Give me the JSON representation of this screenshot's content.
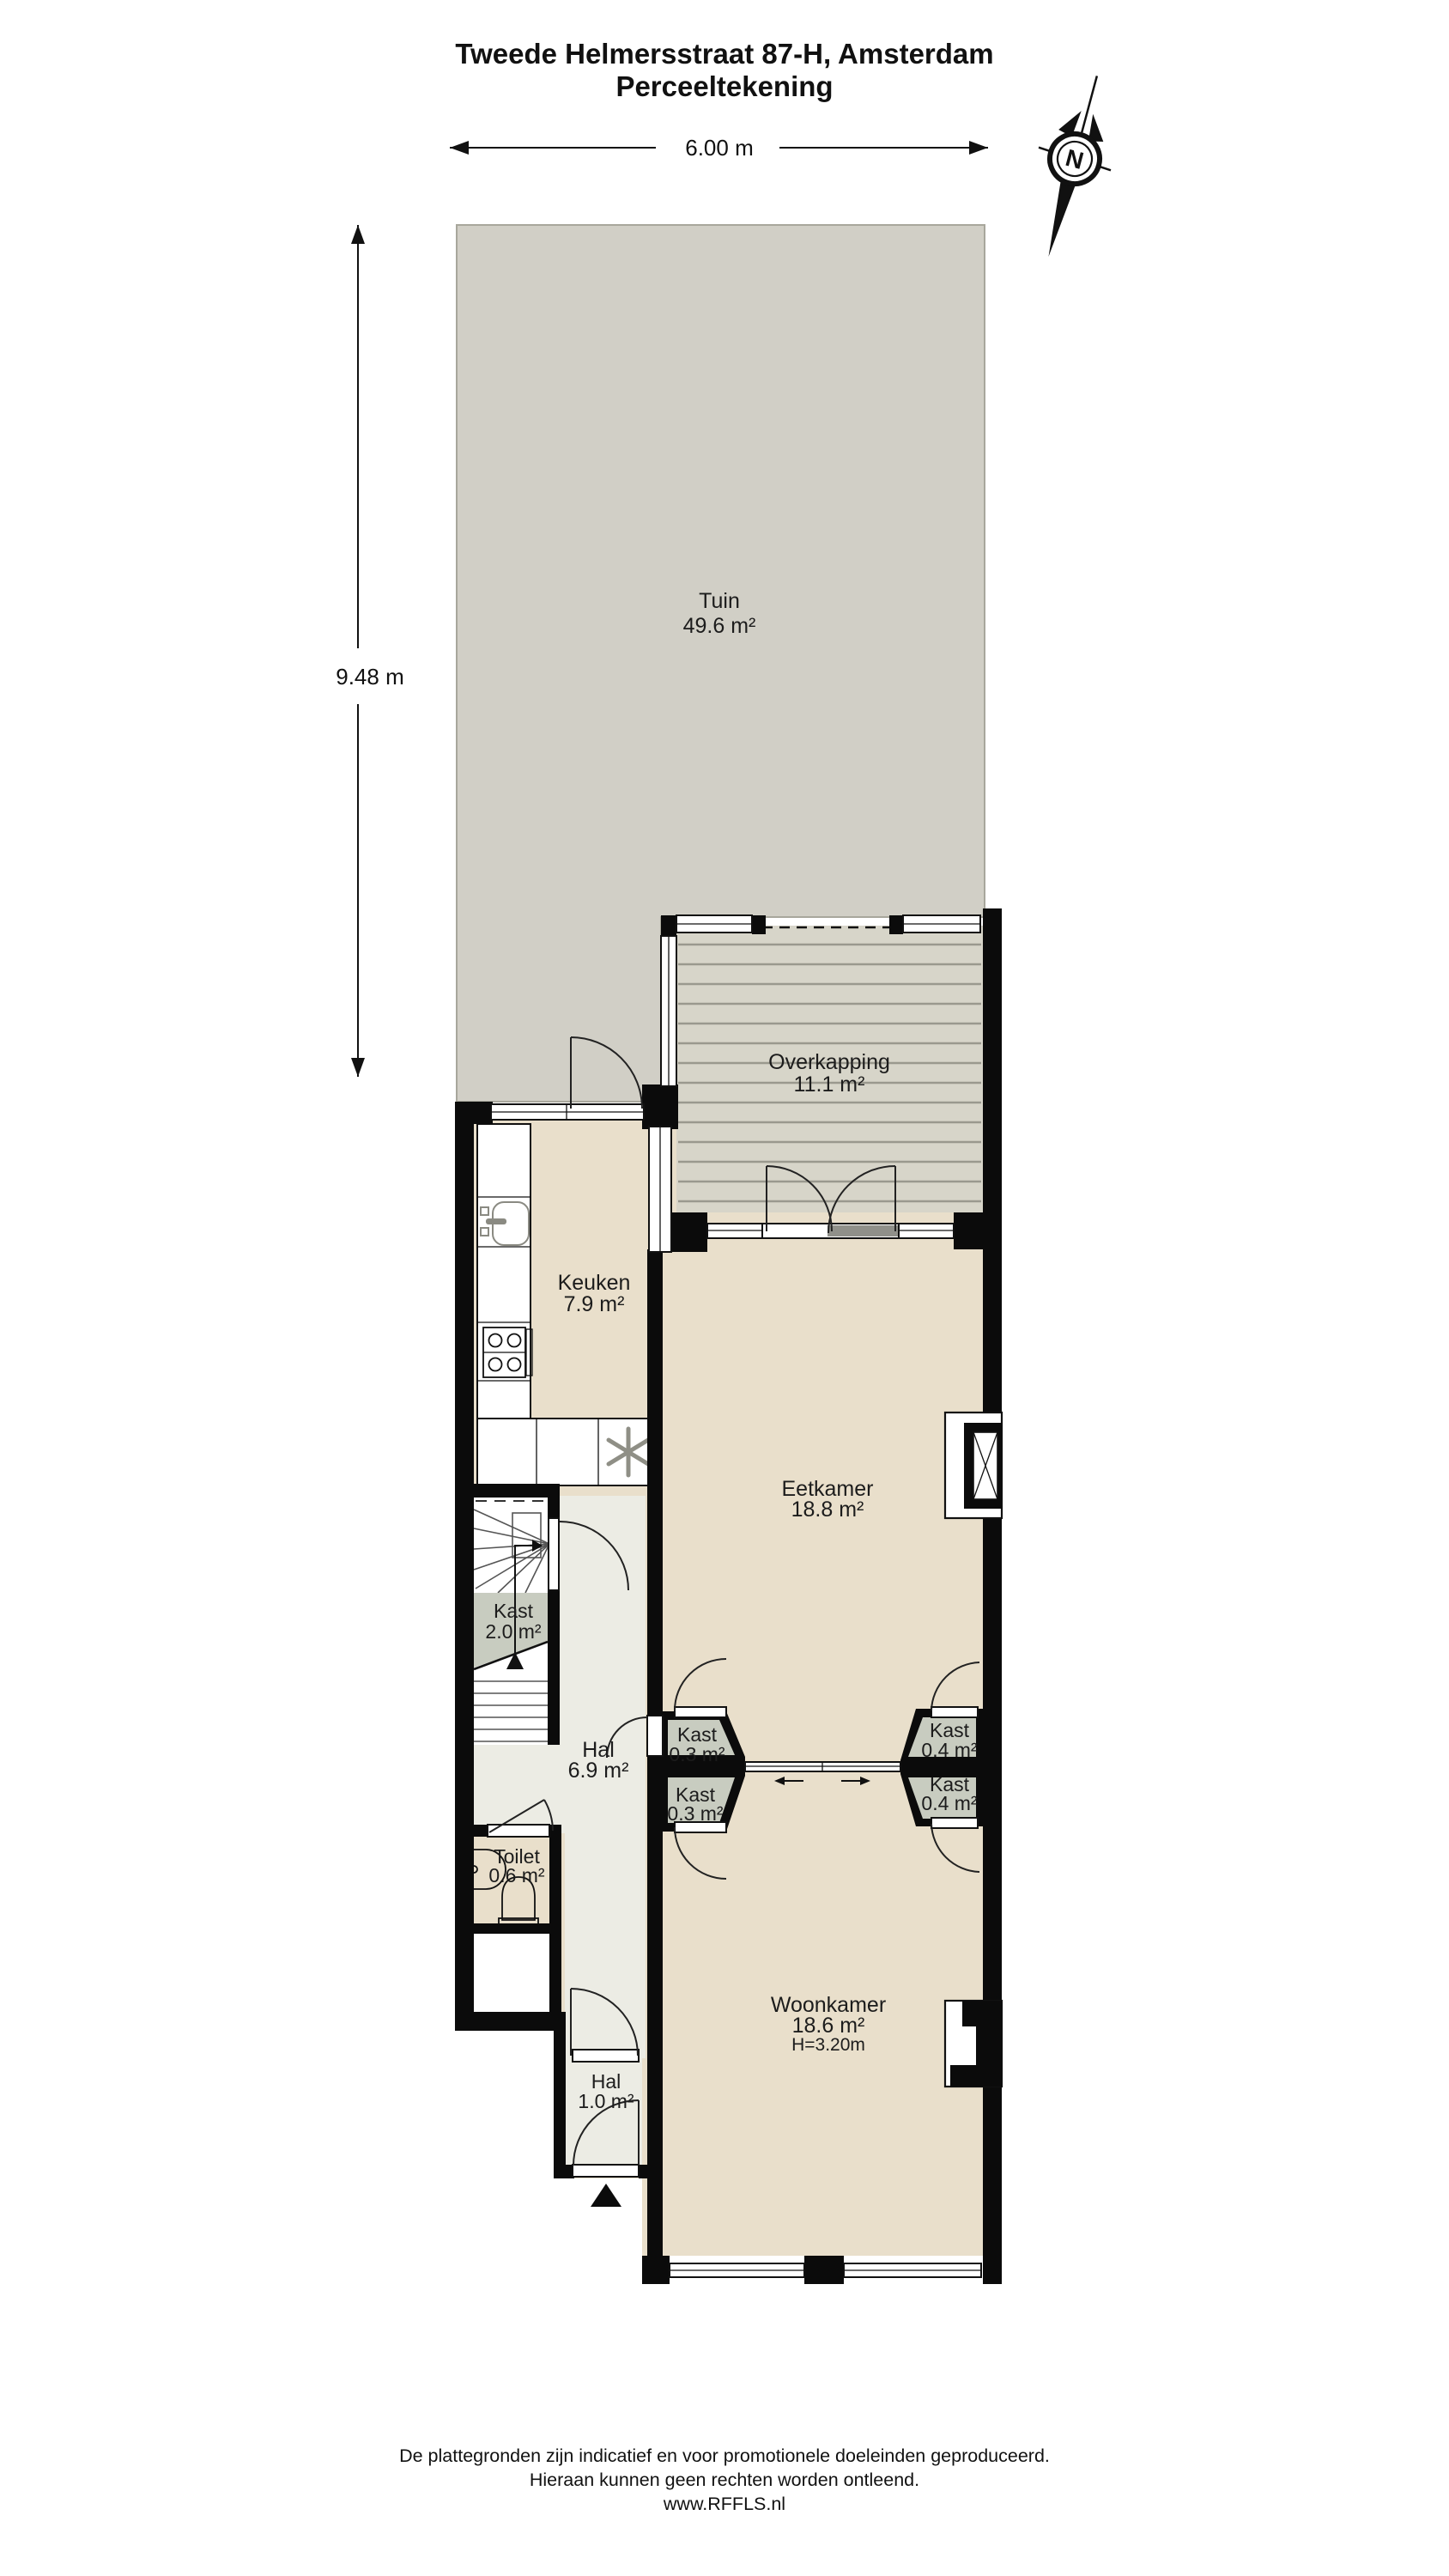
{
  "title": {
    "line1": "Tweede Helmersstraat 87-H, Amsterdam",
    "line2": "Perceeltekening"
  },
  "dimensions": {
    "width_label": "6.00 m",
    "height_label": "9.48 m"
  },
  "compass": {
    "north_label": "N"
  },
  "rooms": {
    "tuin": {
      "name": "Tuin",
      "area": "49.6 m²"
    },
    "overkapping": {
      "name": "Overkapping",
      "area": "11.1 m²"
    },
    "keuken": {
      "name": "Keuken",
      "area": "7.9 m²"
    },
    "eetkamer": {
      "name": "Eetkamer",
      "area": "18.8 m²"
    },
    "kast_trap": {
      "name": "Kast",
      "area": "2.0 m²"
    },
    "hal": {
      "name": "Hal",
      "area": "6.9 m²"
    },
    "kast_links_noord": {
      "name": "Kast",
      "area": "0.3 m²"
    },
    "kast_links_zuid": {
      "name": "Kast",
      "area": "0.3 m²"
    },
    "kast_rechts_noord": {
      "name": "Kast",
      "area": "0.4 m²"
    },
    "kast_rechts_zuid": {
      "name": "Kast",
      "area": "0.4 m²"
    },
    "toilet": {
      "name": "Toilet",
      "area": "0.6 m²"
    },
    "woonkamer": {
      "name": "Woonkamer",
      "area": "18.6 m²",
      "ceiling": "H=3.20m"
    },
    "entree_hal": {
      "name": "Hal",
      "area": "1.0 m²"
    }
  },
  "footer": {
    "line1": "De plattegronden zijn indicatief en voor promotionele doeleinden geproduceerd.",
    "line2": "Hieraan kunnen geen rechten worden ontleend.",
    "line3": "www.RFFLS.nl"
  },
  "colors": {
    "wall": "#0b0b0b",
    "garden": "#d1cfc6",
    "deck": "#d7d5c9",
    "deck_line": "#9a998e",
    "room_floor": "#e9dfcb",
    "hall_floor": "#ececE4",
    "closet": "#c8ccc0",
    "text": "#1c1c1c"
  }
}
